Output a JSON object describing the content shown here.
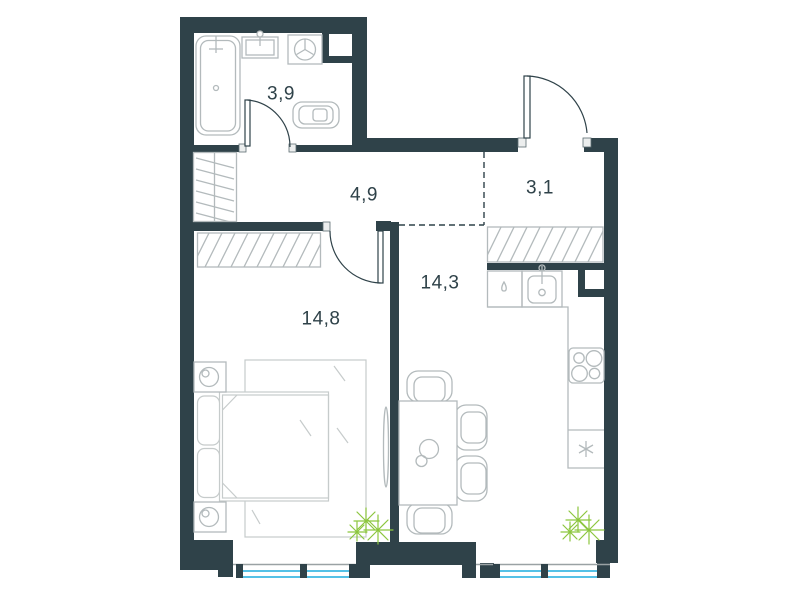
{
  "floor_plan": {
    "rooms": [
      {
        "id": "bathroom",
        "area": "3,9"
      },
      {
        "id": "hallway",
        "area": "4,9"
      },
      {
        "id": "entry",
        "area": "3,1"
      },
      {
        "id": "kitchen-living",
        "area": "14,3"
      },
      {
        "id": "bedroom",
        "area": "14,8"
      }
    ],
    "colors": {
      "wall": "#2f4249",
      "fixture_line": "#b3babc",
      "window_glass": "#55c1e6",
      "plant": "#8cc63e"
    }
  }
}
